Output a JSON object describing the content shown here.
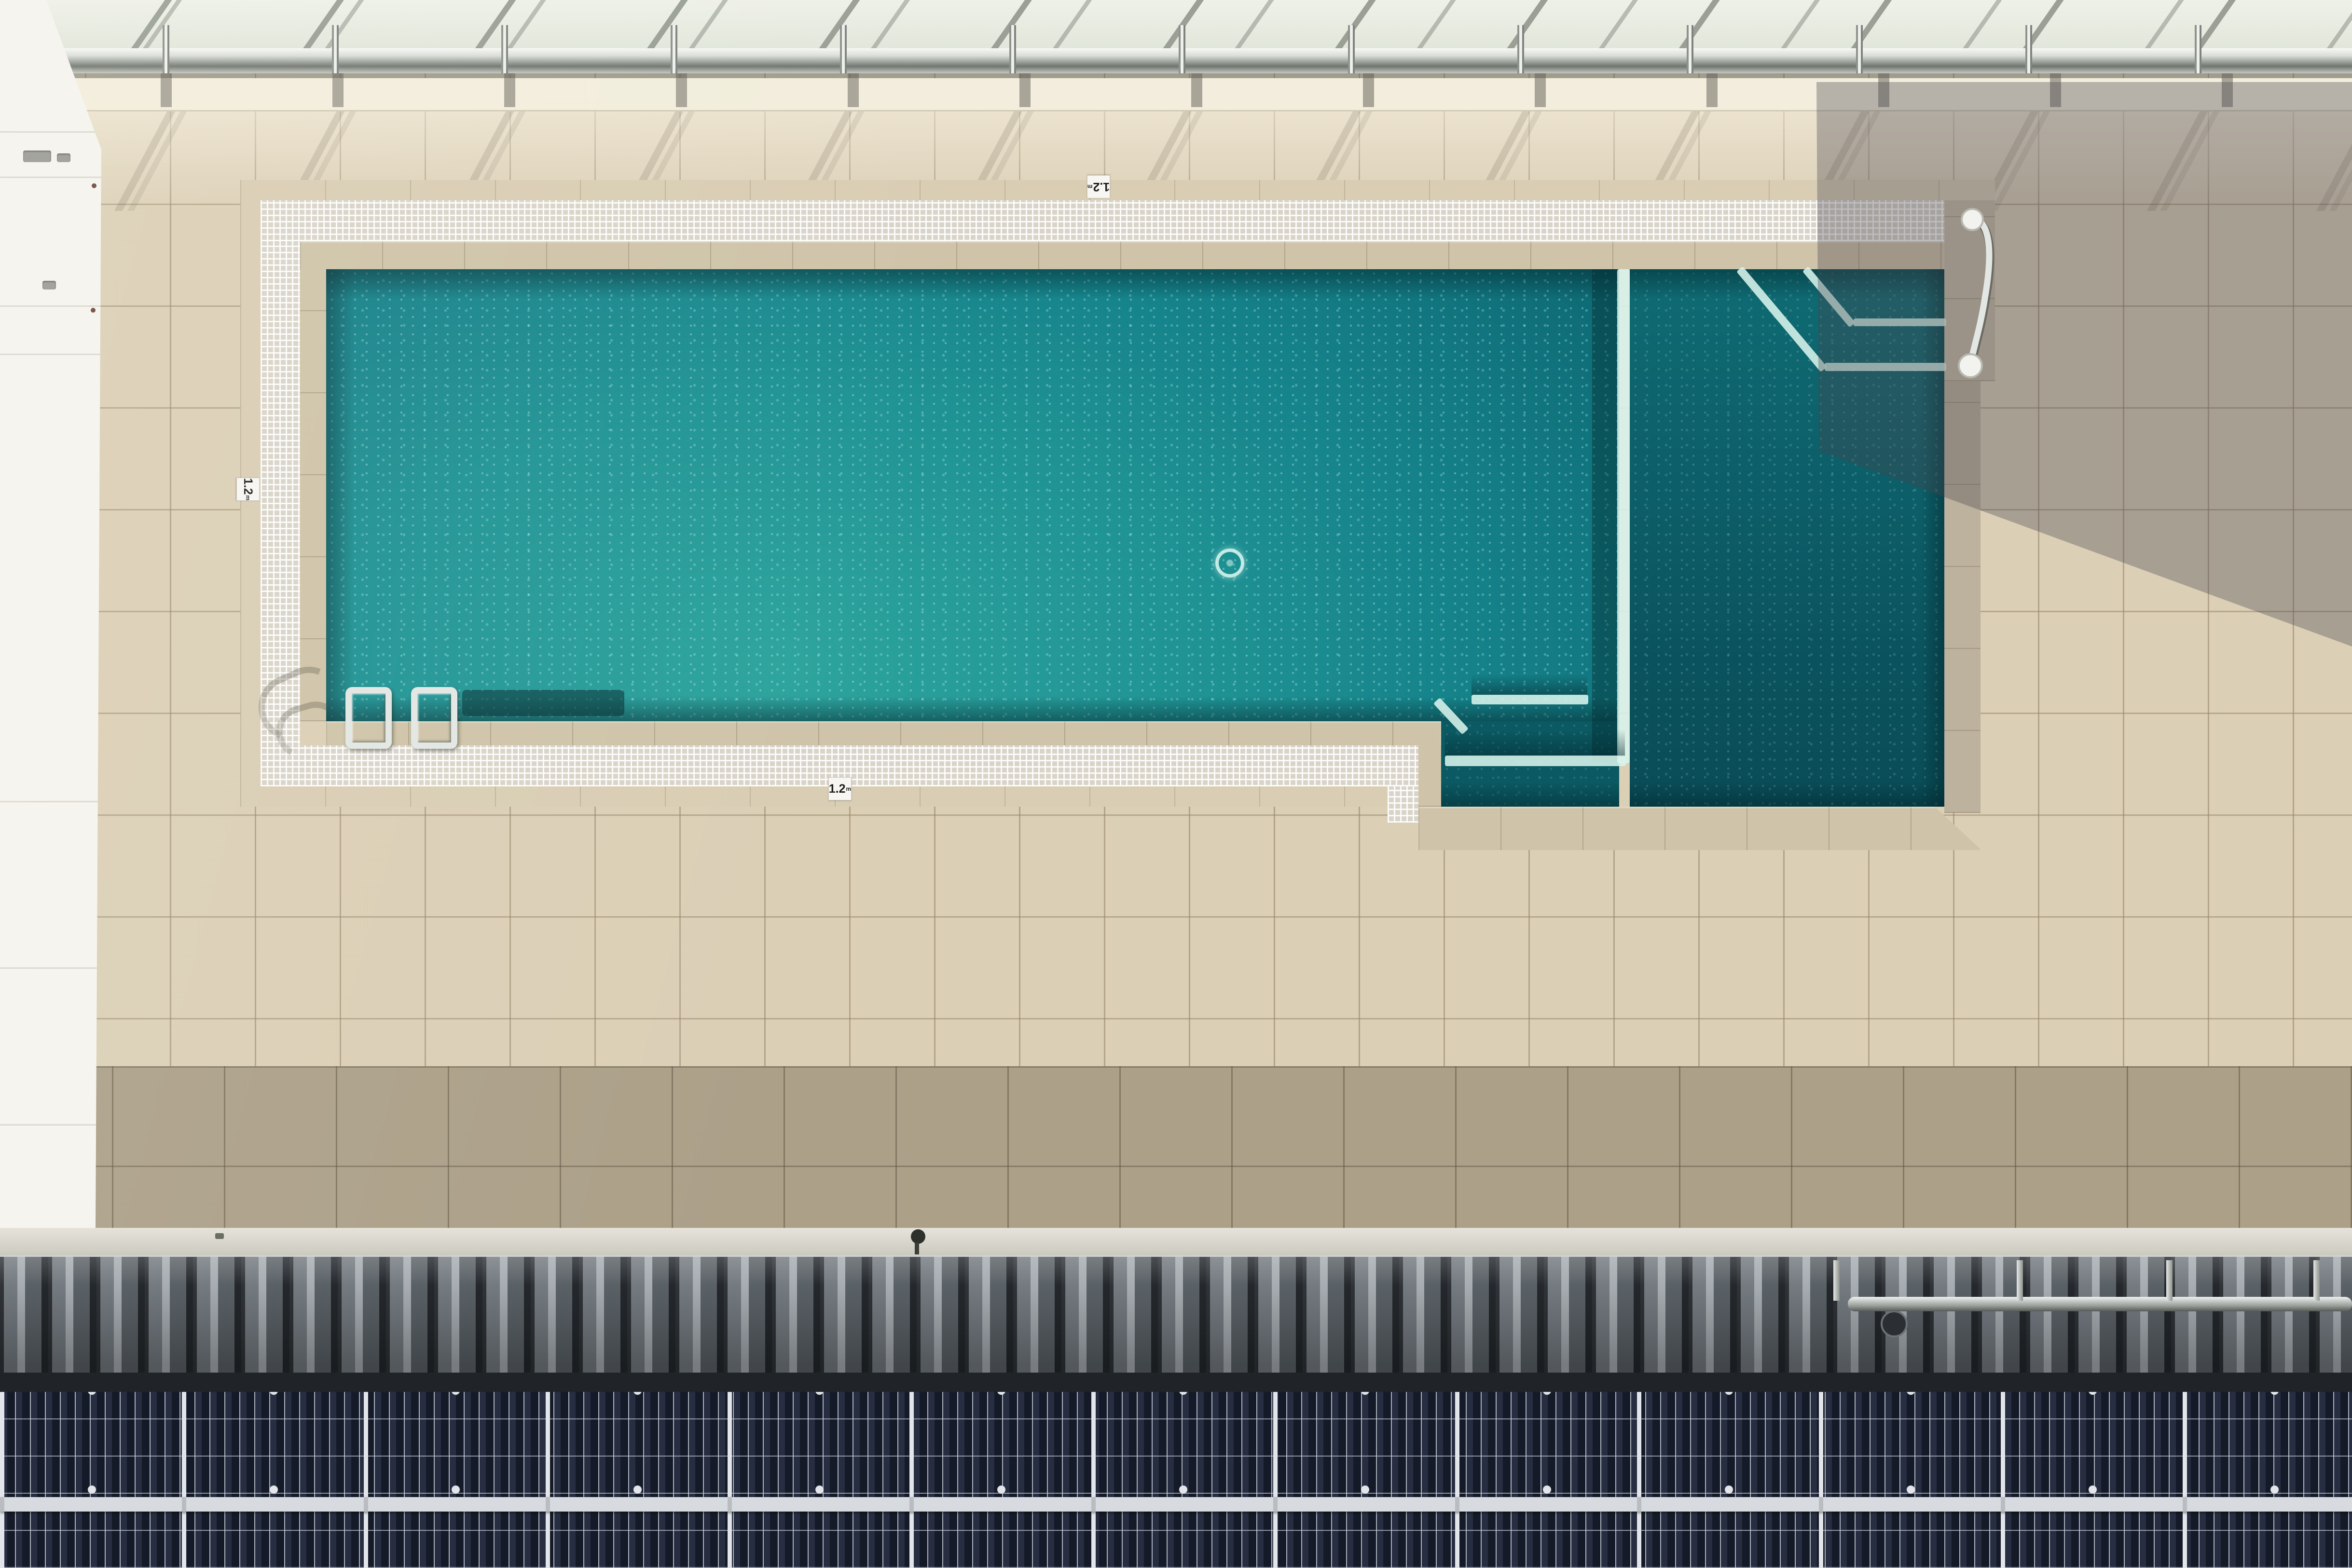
{
  "scene": {
    "description": "Aerial top-down view of a rooftop lap swimming pool with beige tiled deck, white mosaic border, glass balustrade at top, building shadow on the right, and a row of solar panels along the bottom",
    "type": "aerial-photograph"
  },
  "pool": {
    "depth_markers": [
      {
        "position": "top-edge",
        "label": "1.2",
        "unit": "m"
      },
      {
        "position": "left-edge",
        "label": "1.2",
        "unit": "m"
      },
      {
        "position": "bottom-edge",
        "label": "1.2",
        "unit": "m"
      }
    ],
    "features": [
      "ladder",
      "grab-handrail",
      "corner-steps",
      "submerged-step-stripes",
      "circular-drain"
    ]
  },
  "railing": {
    "post_count": 14,
    "style": "glass balustrade with stainless rail"
  },
  "solar_array": {
    "rows": 2,
    "modules_per_row": 13,
    "cell_columns_per_module": 12
  },
  "colors": {
    "deck_lit": "#dbcfb6",
    "deck_lower": "#aca089",
    "outer_band": "#d9ceb4",
    "wall_white": "#f5f3ee",
    "ledge": "#f2eddc",
    "mosaic_tile": "#d9d4c9",
    "coping": "#cfc4a9",
    "coping_col": "#c8bda7",
    "water_main": "#15828a",
    "water_bright": "#2da49d",
    "water_right": "#0c5d67",
    "water_right_deep": "#094c56",
    "water_step_stripe": "#d8f4ec",
    "ladder_chrome": "#e3e7e4",
    "shadow_tint": "rgba(72,70,78,0.35)",
    "gutter": "#ccc9bf",
    "corr_dark": "#2f3337",
    "corr_mid": "#6d7479",
    "corr_light": "#a6acb1",
    "gap_dark": "#202428",
    "solar_cell": "#151a28",
    "solar_frame": "#e2e6ea",
    "marker_bg": "#f7f6f2",
    "marker_text": "#1d1d1b"
  }
}
